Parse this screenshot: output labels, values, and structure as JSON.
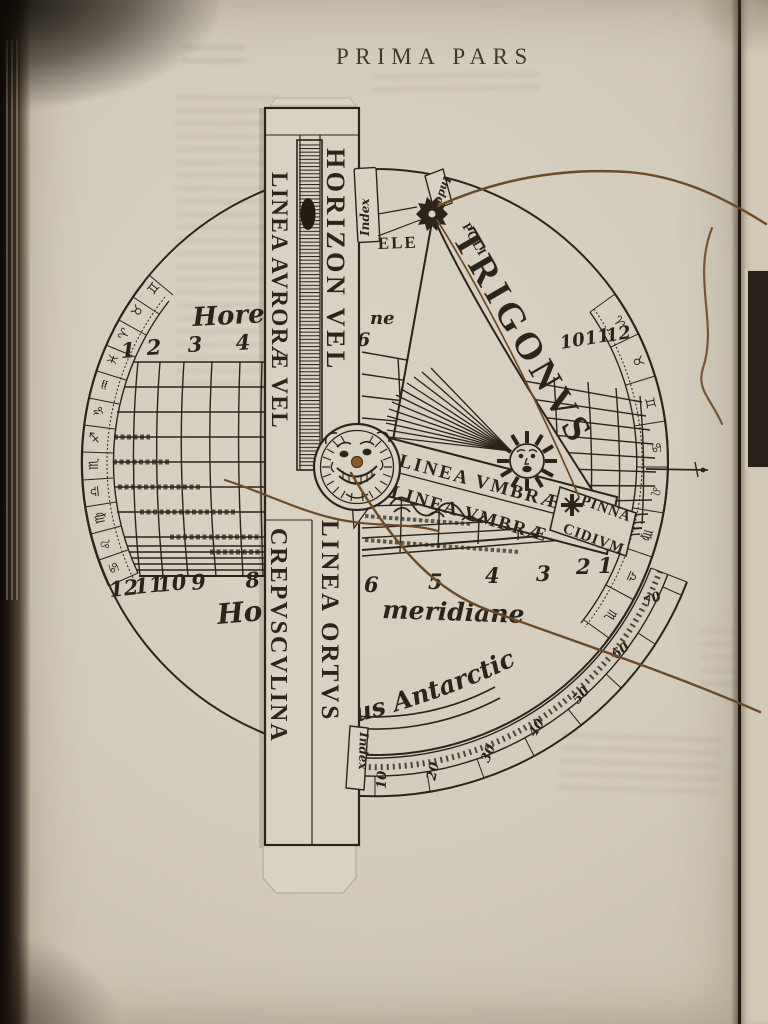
{
  "header": {
    "title": "PRIMA PARS"
  },
  "ruler": {
    "left_top": "LINEA AVRORÆ VEL",
    "right_top": "HORIZON VEL",
    "left_bottom": "CREPVSCVLINA",
    "right_bottom": "LINEA ORTVS"
  },
  "triangle": {
    "name": "TRIGONVS",
    "pole": "POLI",
    "elevation": "ELE"
  },
  "arm": {
    "umbra_upper": "LINEA VMBRÆ",
    "umbra_lower": "LINEA VMBRÆ",
    "pinna": "PINNA",
    "cidium": "CIDIVM"
  },
  "labels": {
    "hore_top": "Hore",
    "hore_top_right": "ne",
    "hore_bottom_left": "Hor",
    "hore_bottom_right": "meridiane",
    "antarcticus": "us Antarcticus",
    "index_top_left": "Index",
    "index_top_right": "Index",
    "index_bottom": "Index"
  },
  "hours": {
    "top_left": [
      "1",
      "2",
      "3",
      "4"
    ],
    "top_right_first": "6",
    "top_right": [
      "10",
      "11",
      "12"
    ],
    "bottom_left": [
      "12",
      "11",
      "10",
      "9",
      "8"
    ],
    "bottom_right": [
      "6",
      "5",
      "4",
      "3",
      "2",
      "1"
    ]
  },
  "degrees": [
    "10",
    "20",
    "30",
    "40",
    "50",
    "60",
    "70"
  ],
  "zodiac": {
    "left": [
      "♋",
      "♌",
      "♍",
      "♎",
      "♏",
      "♐",
      "♑",
      "♒",
      "♓",
      "♈",
      "♉",
      "♊"
    ],
    "right": [
      "♈",
      "♉",
      "♊",
      "♋",
      "♌",
      "♍",
      "♎",
      "♏"
    ]
  },
  "colors": {
    "ink": "#2b241b",
    "paper": "#d5cdbd",
    "thread": "#6d4a26",
    "pin": "#8a5a2b"
  }
}
